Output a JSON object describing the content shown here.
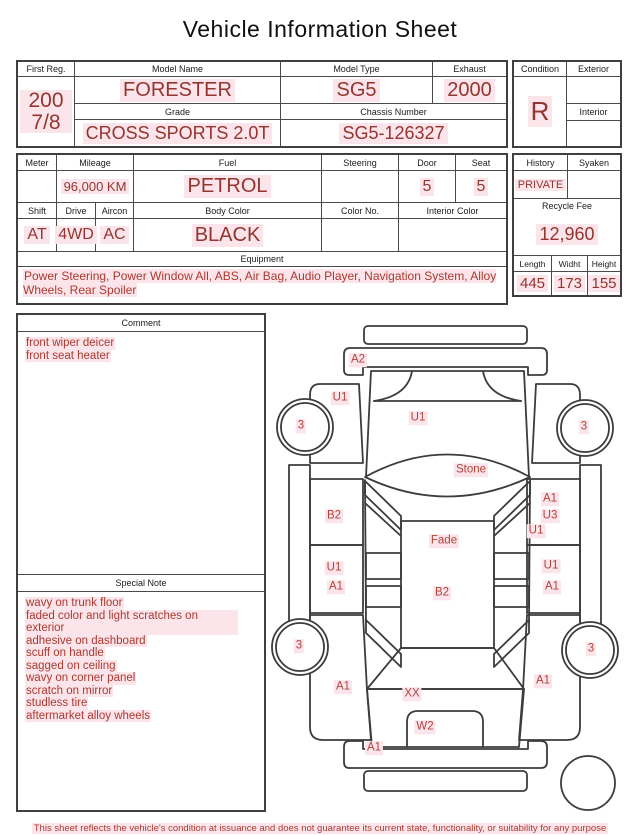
{
  "title": "Vehicle Information Sheet",
  "colors": {
    "accent_red": "#943530",
    "note_red": "#ac3a30",
    "diagram_red": "#b2423a",
    "highlight_pink": "#fbe4ea",
    "border": "#3f3f3f"
  },
  "info1": {
    "first_reg_label": "First Reg.",
    "first_reg": "2007/8",
    "model_name_label": "Model Name",
    "model_name": "FORESTER",
    "model_type_label": "Model Type",
    "model_type": "SG5",
    "exhaust_label": "Exhaust",
    "exhaust": "2000",
    "grade_label": "Grade",
    "grade": "CROSS SPORTS 2.0T",
    "chassis_label": "Chassis Number",
    "chassis": "SG5-126327",
    "condition_label": "Condition",
    "condition": "R",
    "exterior_label": "Exterior",
    "exterior": "",
    "interior_label": "Interior",
    "interior": ""
  },
  "info2": {
    "meter_label": "Meter",
    "meter": "",
    "mileage_label": "Mileage",
    "mileage": "96,000 KM",
    "fuel_label": "Fuel",
    "fuel": "PETROL",
    "steering_label": "Steering",
    "steering": "",
    "door_label": "Door",
    "door": "5",
    "seat_label": "Seat",
    "seat": "5",
    "shift_label": "Shift",
    "shift": "AT",
    "drive_label": "Drive",
    "drive": "4WD",
    "aircon_label": "Aircon",
    "aircon": "AC",
    "body_color_label": "Body Color",
    "body_color": "BLACK",
    "color_no_label": "Color No.",
    "color_no": "",
    "interior_color_label": "Interior Color",
    "interior_color": "",
    "equipment_label": "Equipment",
    "equipment_text": "Power Steering, Power Window All, ABS, Air Bag, Audio Player, Navigation System, Alloy Wheels, Rear Spoiler"
  },
  "side": {
    "history_label": "History",
    "history": "PRIVATE",
    "syaken_label": "Syaken",
    "syaken": "",
    "recycle_fee_label": "Recycle Fee",
    "recycle_fee": "12,960",
    "length_label": "Length",
    "length": "445",
    "width_label": "Widht",
    "width": "173",
    "height_label": "Height",
    "height": "155"
  },
  "comment": {
    "label": "Comment",
    "lines": [
      "front wiper deicer",
      "front seat heater"
    ]
  },
  "special_note": {
    "label": "Special Note",
    "lines": [
      "wavy on trunk floor",
      "faded color and light scratches on exterior",
      "adhesive on dashboard",
      "scuff on handle",
      "sagged on ceiling",
      "wavy on corner panel",
      "scratch on mirror",
      "studless tire",
      "aftermarket alloy wheels"
    ]
  },
  "diagram": {
    "labels": [
      {
        "t": "A2",
        "x": 88,
        "y": 50
      },
      {
        "t": "U1",
        "x": 70,
        "y": 88
      },
      {
        "t": "3",
        "x": 31,
        "y": 116
      },
      {
        "t": "U1",
        "x": 148,
        "y": 108
      },
      {
        "t": "3",
        "x": 314,
        "y": 117
      },
      {
        "t": "Stone",
        "x": 201,
        "y": 160
      },
      {
        "t": "B2",
        "x": 64,
        "y": 206
      },
      {
        "t": "A1",
        "x": 280,
        "y": 189
      },
      {
        "t": "U3",
        "x": 280,
        "y": 206
      },
      {
        "t": "U1",
        "x": 266,
        "y": 221
      },
      {
        "t": "Fade",
        "x": 174,
        "y": 231
      },
      {
        "t": "U1",
        "x": 64,
        "y": 258
      },
      {
        "t": "A1",
        "x": 66,
        "y": 277
      },
      {
        "t": "B2",
        "x": 172,
        "y": 283
      },
      {
        "t": "U1",
        "x": 281,
        "y": 256
      },
      {
        "t": "A1",
        "x": 282,
        "y": 277
      },
      {
        "t": "3",
        "x": 29,
        "y": 336
      },
      {
        "t": "3",
        "x": 321,
        "y": 339
      },
      {
        "t": "A1",
        "x": 73,
        "y": 377
      },
      {
        "t": "A1",
        "x": 273,
        "y": 371
      },
      {
        "t": "XX",
        "x": 142,
        "y": 384
      },
      {
        "t": "W2",
        "x": 155,
        "y": 417
      },
      {
        "t": "A1",
        "x": 104,
        "y": 438
      }
    ]
  },
  "footer": "This sheet reflects the vehicle's condition at issuance and does not guarantee its current state, functionality, or suitability for any purpose"
}
